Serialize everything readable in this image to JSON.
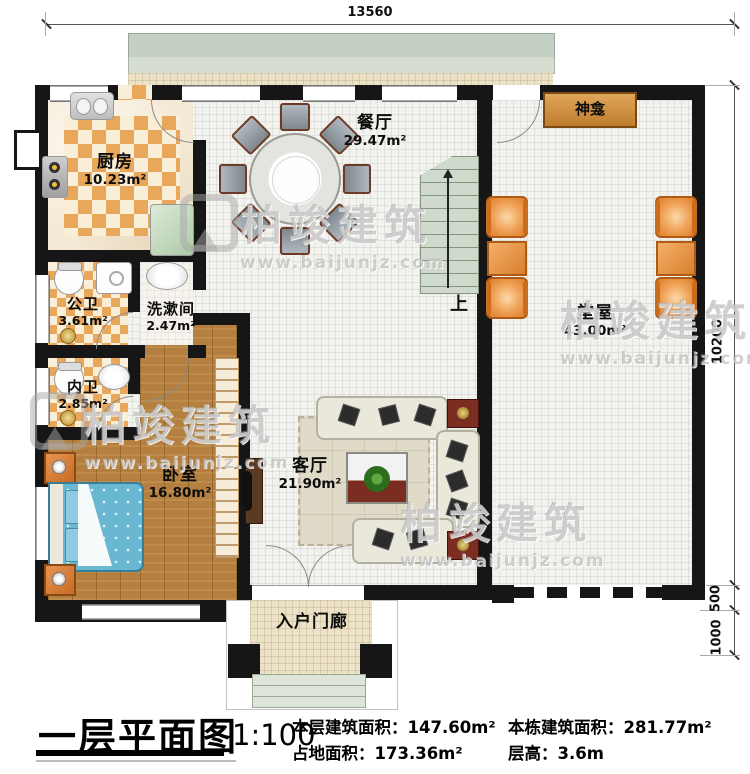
{
  "dimensions": {
    "top_width": "13560",
    "right_height": "10200",
    "right_step": "500",
    "right_porch": "1000"
  },
  "rooms": {
    "kitchen": {
      "name": "厨房",
      "area": "10.23m²"
    },
    "dining": {
      "name": "餐厅",
      "area": "29.47m²"
    },
    "public_bath": {
      "name": "公卫",
      "area": "3.61m²"
    },
    "washroom": {
      "name": "洗漱间",
      "area": "2.47m²"
    },
    "ensuite_bath": {
      "name": "内卫",
      "area": "2.85m²"
    },
    "bedroom": {
      "name": "卧室",
      "area": "16.80m²"
    },
    "living": {
      "name": "客厅",
      "area": "21.90m²"
    },
    "hall": {
      "name": "堂屋",
      "area": "43.00m²"
    },
    "porch": {
      "name": "入户门廊"
    }
  },
  "features": {
    "shrine": "神龛",
    "stairs_up": "上"
  },
  "watermark": {
    "brand": "柏竣建筑",
    "url": "www.baijunjz.com"
  },
  "title_block": {
    "title": "一层平面图",
    "scale": "1:100",
    "stats": [
      {
        "label": "本层建筑面积：",
        "value": "147.60m²"
      },
      {
        "label": "占地面积：",
        "value": "173.36m²"
      },
      {
        "label": "本栋建筑面积：",
        "value": "281.77m²"
      },
      {
        "label": "层高：",
        "value": "3.6m"
      }
    ]
  },
  "colors": {
    "wall": "#161616",
    "checker_orange": "#e9a75c",
    "wood_floor": "#b5803f",
    "bed_teal": "#6ab7d2",
    "hall_chair_orange": "#ef9e52",
    "stair_green": "#cfd9cc"
  }
}
